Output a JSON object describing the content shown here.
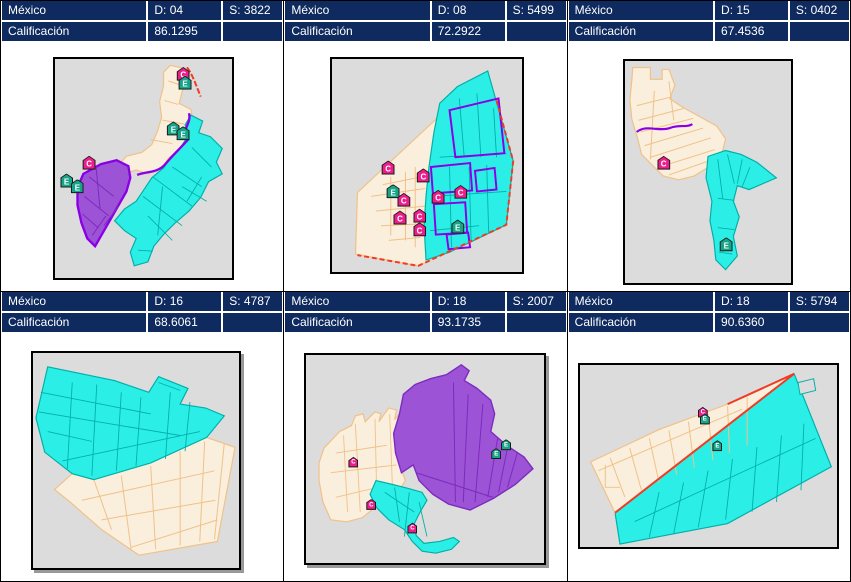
{
  "colors": {
    "header_bg": "#0E2A5E",
    "header_text": "#FFFFFF",
    "map_bg": "#DCDCDC",
    "cream": "#FAEEDC",
    "cream_border": "#F0C188",
    "cyan": "#2BEFE6",
    "cyan_border": "#00AFA8",
    "purple": "#9C53D6",
    "purple_border": "#7D2ABF",
    "purple_boundary": "#8A00E6",
    "red": "#F03A22",
    "marker_e": "#17A589",
    "marker_c": "#EC1E8C"
  },
  "panels": [
    {
      "country": "México",
      "district": "D: 04",
      "section": "S: 3822",
      "score_label": "Calificación",
      "score": "86.1295",
      "small_markers": false,
      "icons": [
        {
          "letter": "C",
          "x": 72.5,
          "y": 7.5
        },
        {
          "letter": "E",
          "x": 73.5,
          "y": 11.5
        },
        {
          "letter": "E",
          "x": 66.9,
          "y": 32.3
        },
        {
          "letter": "E",
          "x": 72.4,
          "y": 34.5
        },
        {
          "letter": "C",
          "x": 19.3,
          "y": 48.0
        },
        {
          "letter": "E",
          "x": 6.5,
          "y": 56.1
        },
        {
          "letter": "E",
          "x": 12.7,
          "y": 58.7
        }
      ]
    },
    {
      "country": "México",
      "district": "D: 08",
      "section": "S: 5499",
      "score_label": "Calificación",
      "score": "72.2922",
      "small_markers": false,
      "icons": [
        {
          "letter": "C",
          "x": 29.4,
          "y": 51.6
        },
        {
          "letter": "E",
          "x": 32.0,
          "y": 62.7
        },
        {
          "letter": "C",
          "x": 47.9,
          "y": 55.3
        },
        {
          "letter": "C",
          "x": 37.6,
          "y": 66.8
        },
        {
          "letter": "C",
          "x": 55.7,
          "y": 65.4
        },
        {
          "letter": "C",
          "x": 67.5,
          "y": 63.1
        },
        {
          "letter": "C",
          "x": 35.6,
          "y": 75.1
        },
        {
          "letter": "C",
          "x": 45.9,
          "y": 74.2
        },
        {
          "letter": "C",
          "x": 45.9,
          "y": 80.6
        },
        {
          "letter": "E",
          "x": 66.0,
          "y": 79.3
        }
      ]
    },
    {
      "country": "México",
      "district": "D: 15",
      "section": "S: 0402",
      "score_label": "Calificación",
      "score": "67.4536",
      "small_markers": false,
      "icons": [
        {
          "letter": "C",
          "x": 23.5,
          "y": 46.5
        },
        {
          "letter": "E",
          "x": 61.2,
          "y": 83.2
        }
      ]
    },
    {
      "country": "México",
      "district": "D: 16",
      "section": "S: 4787",
      "score_label": "Calificación",
      "score": "68.6061",
      "small_markers": false,
      "icons": []
    },
    {
      "country": "México",
      "district": "D: 18",
      "section": "S: 2007",
      "score_label": "Calificación",
      "score": "93.1735",
      "small_markers": true,
      "icons": [
        {
          "letter": "C",
          "x": 19.8,
          "y": 52.4
        },
        {
          "letter": "C",
          "x": 27.3,
          "y": 72.6
        },
        {
          "letter": "C",
          "x": 44.6,
          "y": 84.0
        },
        {
          "letter": "E",
          "x": 83.9,
          "y": 43.9
        },
        {
          "letter": "E",
          "x": 79.8,
          "y": 48.1
        }
      ]
    },
    {
      "country": "México",
      "district": "D: 18",
      "section": "S: 5794",
      "score_label": "Calificación",
      "score": "90.6360",
      "small_markers": true,
      "icons": [
        {
          "letter": "C",
          "x": 47.9,
          "y": 26.9
        },
        {
          "letter": "E",
          "x": 48.7,
          "y": 30.6
        },
        {
          "letter": "E",
          "x": 53.6,
          "y": 45.2
        }
      ]
    }
  ]
}
